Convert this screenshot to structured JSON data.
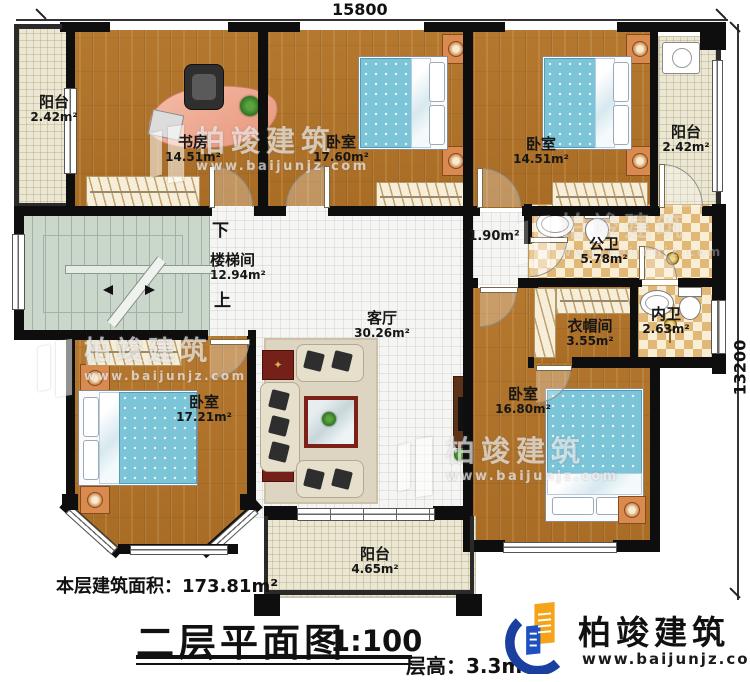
{
  "dimensions": {
    "top": "15800",
    "right": "13200"
  },
  "rooms": {
    "balcony_tl": {
      "name": "阳台",
      "area": "2.42m²"
    },
    "study": {
      "name": "书房",
      "area": "14.51m²"
    },
    "bedroom_top": {
      "name": "卧室",
      "area": "17.60m²"
    },
    "bedroom_tr": {
      "name": "卧室",
      "area": "14.51m²"
    },
    "balcony_right": {
      "name": "阳台",
      "area": "2.42m²"
    },
    "stairwell": {
      "name": "楼梯间",
      "area": "12.94m²",
      "down": "下",
      "up": "上"
    },
    "corridor": {
      "area": "1.90m²"
    },
    "public_bath": {
      "name": "公卫",
      "area": "5.78m²"
    },
    "living": {
      "name": "客厅",
      "area": "30.26m²"
    },
    "cloakroom": {
      "name": "衣帽间",
      "area": "3.55m²"
    },
    "ensuite": {
      "name": "内卫",
      "area": "2.63m²"
    },
    "bedroom_bl": {
      "name": "卧室",
      "area": "17.21m²"
    },
    "bedroom_br": {
      "name": "卧室",
      "area": "16.80m²"
    },
    "balcony_bottom": {
      "name": "阳台",
      "area": "4.65m²"
    }
  },
  "title_block": {
    "floor_area": "本层建筑面积：173.81m²",
    "title": "二层平面图",
    "scale": "1:100",
    "floor_height": "层高：3.3m"
  },
  "watermark": {
    "brand": "柏竣建筑",
    "url": "www.baijunjz.com"
  },
  "logo": {
    "brand": "柏竣建筑",
    "url": "www.baijunjz.com"
  },
  "colors": {
    "wood": "#b0742c",
    "tile_cream": "#ebe7d2",
    "checker": "#e2b877",
    "stair": "#ccd7cc",
    "wall": "#0e0e0e",
    "bed_blue": "#7cc4d8",
    "logo_blue": "#1a3f9e",
    "logo_orange": "#f5a31a"
  }
}
